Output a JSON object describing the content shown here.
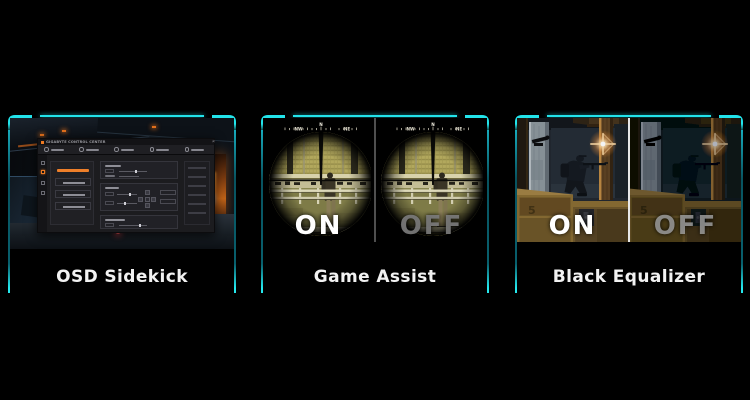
{
  "cards": [
    {
      "title": "OSD Sidekick"
    },
    {
      "title": "Game Assist",
      "on": "ON",
      "off": "OFF",
      "compass": {
        "west": "NW",
        "center": "N",
        "east": "NE"
      }
    },
    {
      "title": "Black Equalizer",
      "on": "ON",
      "off": "OFF",
      "crate_stencil": "5"
    }
  ],
  "osd_app": {
    "title": "GIGABYTE CONTROL CENTER",
    "window_controls": {
      "minimize": "–",
      "close": "×"
    }
  },
  "colors": {
    "accent_cyan": "#22e3ea",
    "accent_teal": "#0d7f8f",
    "accent_orange": "#ee7a22",
    "on_text": "#ffffff",
    "off_text_game_assist": "#7d7d7d",
    "off_text_black_equalizer": "#a5a5a5",
    "label_text": "#f2f2f2"
  }
}
